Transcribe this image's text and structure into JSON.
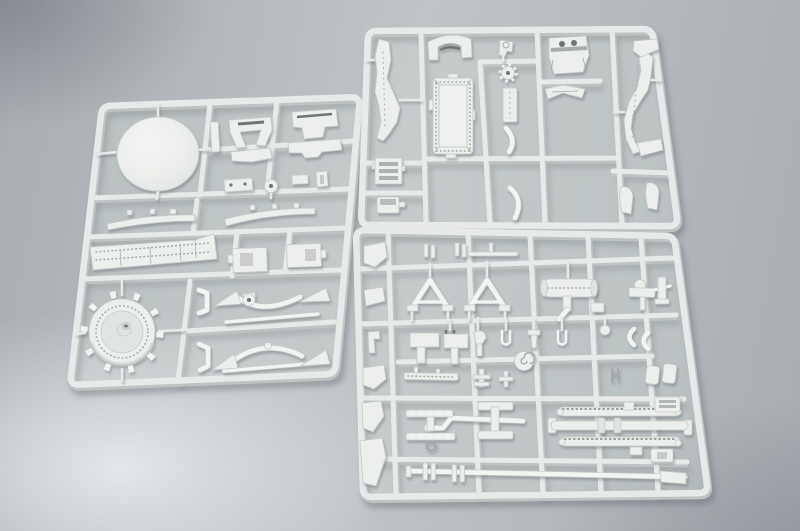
{
  "scene": {
    "description": "Overhead photograph of three light-gray injection-molded plastic model-kit sprues (runner frames full of unassembled tank parts) lying on a smooth gray studio surface with soft lighting; one tall sprue on the left with a large dome and a toothed wheel, one wide sprue at the upper right with a riveted roof panel and two long fenders, and one dense sprue at the lower right full of small suspension parts, springs and axles.",
    "surface": "smooth gray studio background, lighter at lower left, darker toward the corners",
    "sprues": [
      {
        "label": "left sprue",
        "parts": [
          "large dome",
          "windshield frame",
          "wing plate",
          "mount brackets",
          "small plate and disc",
          "two fender strips",
          "riveted hull side",
          "two bracket boxes",
          "toothed road wheel with hub",
          "upper suspension bow with pulley",
          "lower suspension arch",
          "two crank links"
        ]
      },
      {
        "label": "upper right sprue",
        "parts": [
          "left long fender",
          "right long fender",
          "mudguard arch",
          "periscope knob",
          "small gear wheel",
          "seat plate with two holes",
          "riveted roof panel",
          "track link section",
          "storage box",
          "narrow panel",
          "curved rails",
          "wing plate",
          "four mudguard segments"
        ]
      },
      {
        "label": "lower right sprue",
        "parts": [
          "locating pins and rod",
          "six ramp brackets",
          "two tow-bar A-frames",
          "muffler with exhaust pipe",
          "pintle gun mount",
          "row of fork pins",
          "two crescent clamps",
          "spiral horn",
          "two flat T-panels",
          "hook bracket",
          "detailed gun cradle",
          "two cross pins",
          "two leaf springs",
          "main axle",
          "bent pipe",
          "H-stand",
          "two studded torsion bars",
          "long axle rod with collars",
          "two shovel blades",
          "ladder bracket",
          "corner brackets"
        ]
      }
    ]
  },
  "colors": {
    "bg-mid": "#c0c4c7",
    "bg-side": "#a8adb2",
    "glow1": "rgba(231,233,236,0.95)",
    "glow1t": "rgba(231,233,236,0)",
    "dark1": "rgba(82,90,97,0.42)",
    "dark1t": "rgba(82,90,97,0)",
    "dark2": "rgba(98,106,113,0.36)",
    "dark2t": "rgba(98,106,113,0)",
    "plastic": "#e7eae8",
    "plastic-bright": "#f3f5f3",
    "plastic-edge": "#bfc4c2",
    "part": "#edefec",
    "part-dim": "#e1e5e2",
    "part-edge": "#c5cac7",
    "detail": "#a4aaa7",
    "slot": "#6e7573",
    "tint": "rgba(213,220,216,0.32)",
    "cast": "rgba(93,101,108,0.40)"
  }
}
